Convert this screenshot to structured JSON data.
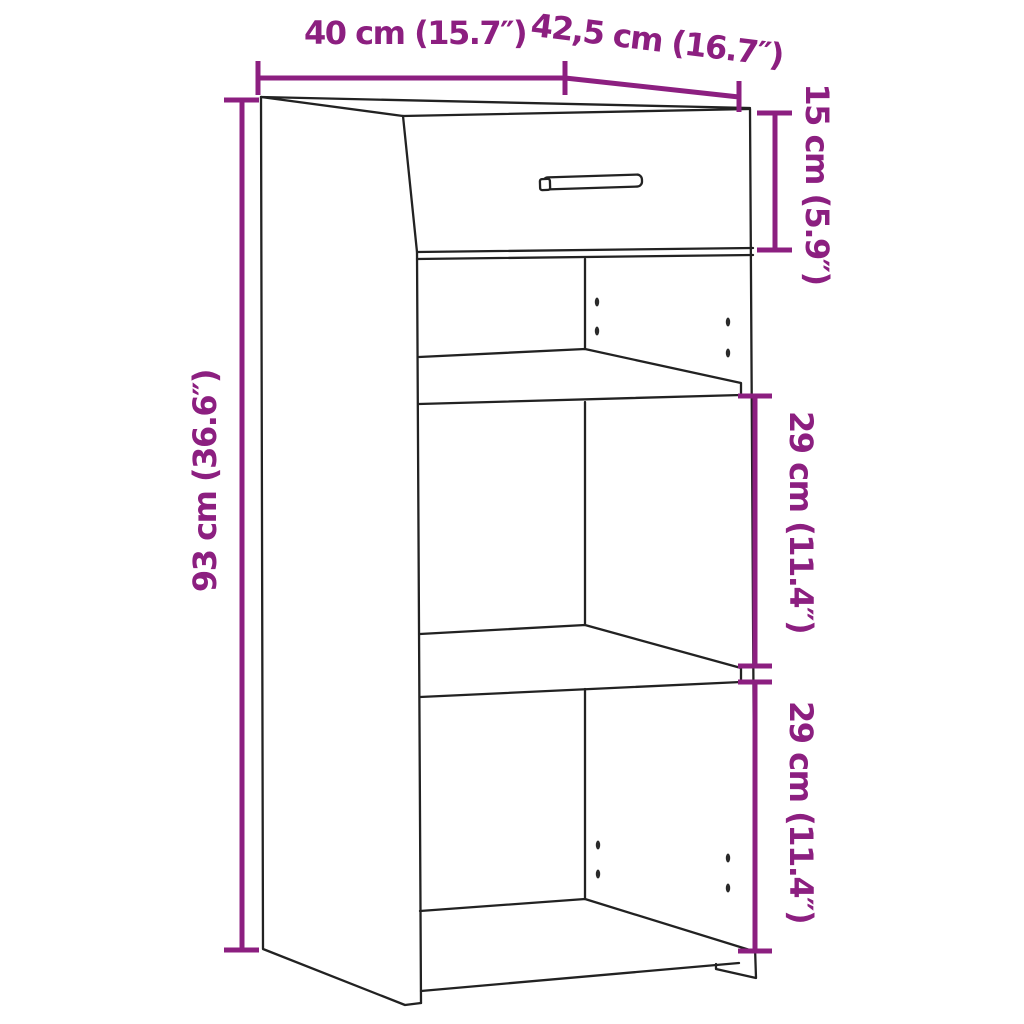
{
  "figure": {
    "type": "product-dimension-diagram",
    "subject": "cabinet with one top drawer and two open shelf compartments"
  },
  "dimension_labels": {
    "width": "40 cm (15.7″)",
    "depth": "42,5 cm (16.7″)",
    "height": "93 cm (36.6″)",
    "drawer": "15 cm (5.9″)",
    "upper_compartment": "29 cm (11.4″)",
    "lower_compartment": "29 cm (11.4″)"
  },
  "colors": {
    "dimension_accent": "#8C1F80",
    "outline": "#222222",
    "background": "#FFFFFF"
  }
}
